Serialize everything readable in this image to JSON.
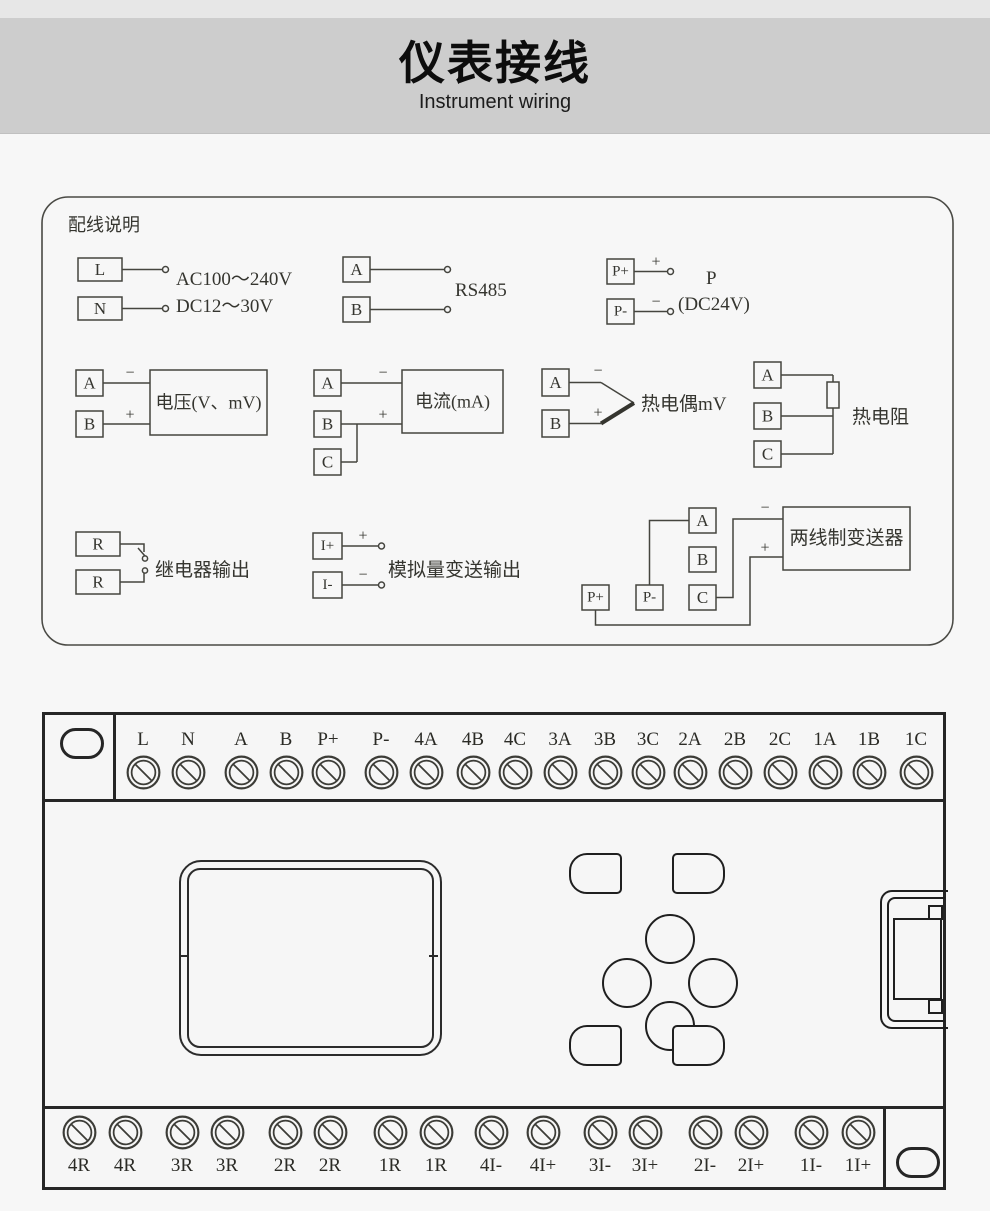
{
  "header": {
    "title": "仪表接线",
    "subtitle": "Instrument wiring"
  },
  "panel": {
    "title": "配线说明",
    "power": {
      "t1": "L",
      "t2": "N",
      "line1": "AC100～240V",
      "line2": "DC12～30V"
    },
    "rs485": {
      "t1": "A",
      "t2": "B",
      "label": "RS485"
    },
    "dc24": {
      "t1": "P+",
      "t2": "P-",
      "plus": "+",
      "minus": "−",
      "line1": "P",
      "line2": "(DC24V)"
    },
    "voltage": {
      "t1": "A",
      "t2": "B",
      "minus": "−",
      "plus": "+",
      "label": "电压(V、mV)"
    },
    "current": {
      "t1": "A",
      "t2": "B",
      "t3": "C",
      "minus": "−",
      "plus": "+",
      "label": "电流(mA)"
    },
    "thermocouple": {
      "t1": "A",
      "t2": "B",
      "minus": "−",
      "plus": "+",
      "label": "热电偶mV"
    },
    "rtd": {
      "t1": "A",
      "t2": "B",
      "t3": "C",
      "label": "热电阻"
    },
    "relay": {
      "t1": "R",
      "t2": "R",
      "label": "继电器输出"
    },
    "analog": {
      "t1": "I+",
      "t2": "I-",
      "plus": "+",
      "minus": "−",
      "label": "模拟量变送输出"
    },
    "transmitter": {
      "a": "A",
      "b": "B",
      "c": "C",
      "pplus": "P+",
      "pminus": "P-",
      "minus": "−",
      "plus": "+",
      "label": "两线制变送器"
    }
  },
  "device": {
    "top_terminals": [
      "L",
      "N",
      "A",
      "B",
      "P+",
      "P-",
      "4A",
      "4B",
      "4C",
      "3A",
      "3B",
      "3C",
      "2A",
      "2B",
      "2C",
      "1A",
      "1B",
      "1C"
    ],
    "bottom_terminals": [
      "4R",
      "4R",
      "3R",
      "3R",
      "2R",
      "2R",
      "1R",
      "1R",
      "4I-",
      "4I+",
      "3I-",
      "3I+",
      "2I-",
      "2I+",
      "1I-",
      "1I+"
    ]
  },
  "colors": {
    "line": "#45453f",
    "device_line": "#262626",
    "band": "#cdcdcd"
  }
}
